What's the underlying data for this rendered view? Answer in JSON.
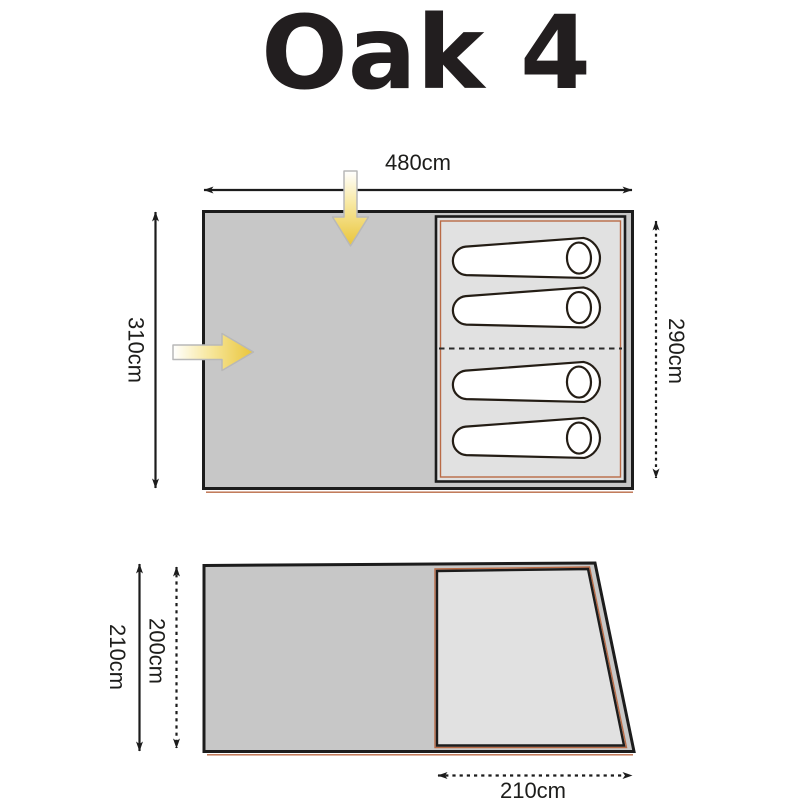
{
  "title": "Oak 4",
  "floor_plan": {
    "width_label": "480cm",
    "depth_label": "310cm",
    "bedroom_depth_label": "290cm",
    "sleeping_bag_count": 4
  },
  "footprint": {
    "depth_label": "210cm",
    "inner_depth_label": "200cm",
    "door_width_label": "210cm"
  },
  "colors": {
    "outline": "#1c1c1c",
    "body_gray": "#c7c7c7",
    "inner_gray": "#e1e1e1",
    "accent_salmon": "#b96a45",
    "arrow_yellow": "#e9c53a"
  }
}
